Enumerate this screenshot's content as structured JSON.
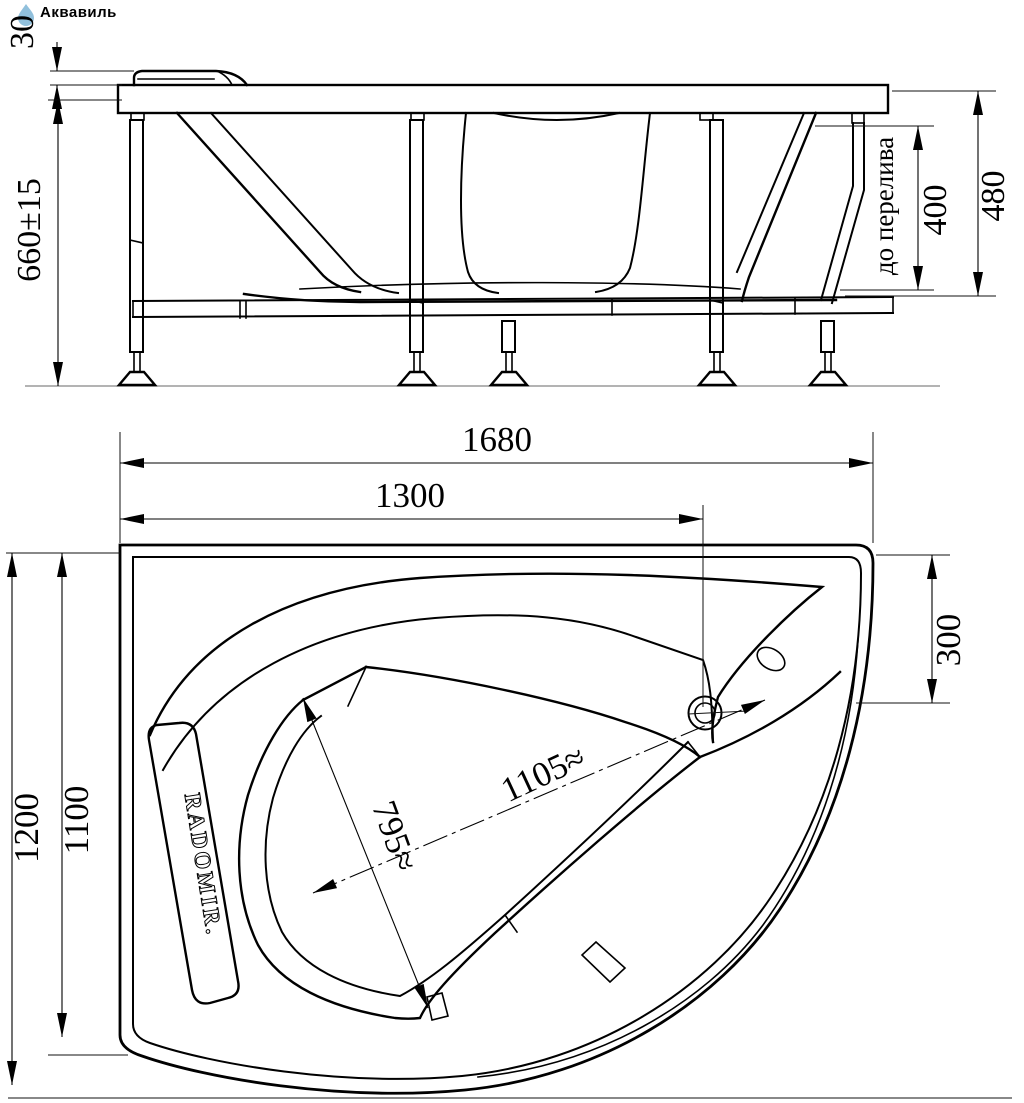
{
  "watermark": {
    "label": "Аквавиль",
    "color": "#85b9d8"
  },
  "drawing": {
    "type": "technical-drawing",
    "subject": "asymmetric corner bathtub with support frame, two projections",
    "units": "mm"
  },
  "front_view": {
    "dims": {
      "headrest_height": "30",
      "floor_to_rim_height": "660±15",
      "rim_to_shell_bottom": "480",
      "overflow_height": "400",
      "overflow_caption": "до перелива"
    }
  },
  "plan_view": {
    "brand_on_pillow": "RADOMIR.",
    "dims": {
      "overall_length": "1680",
      "left_edge_to_drain": "1300",
      "overall_width": "1200",
      "inner_width": "1100",
      "corner_depth": "300",
      "well_diagonal_length": "1105≈",
      "well_diagonal_width": "795≈"
    }
  }
}
